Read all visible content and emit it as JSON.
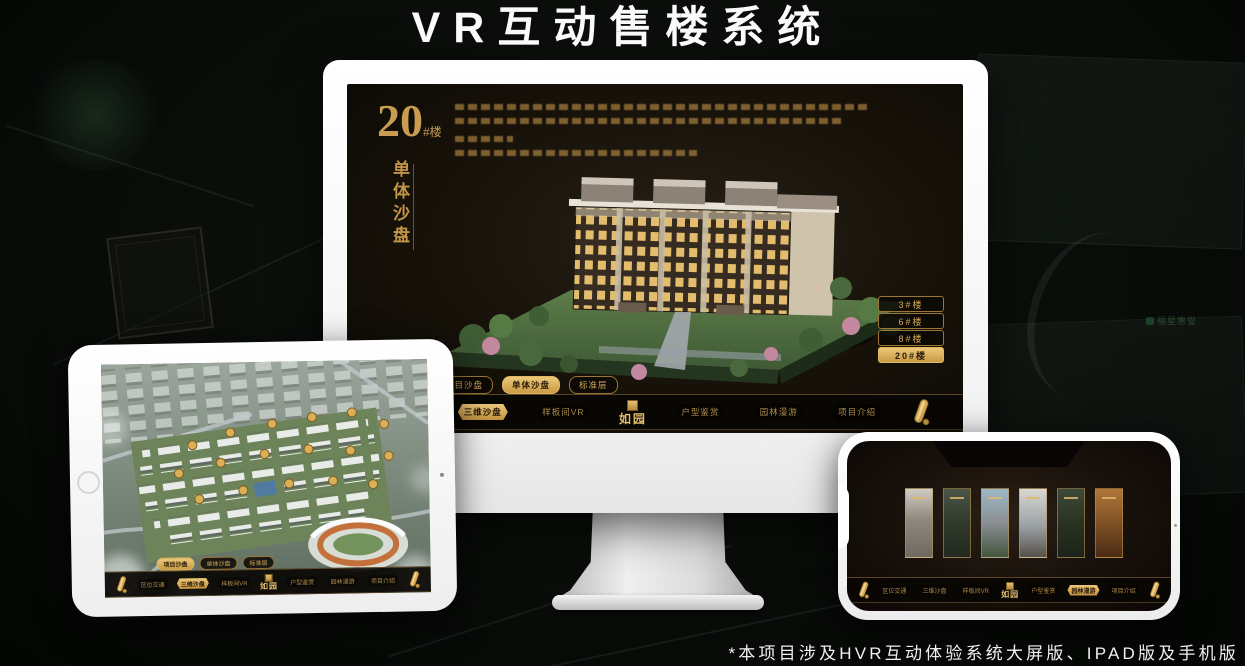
{
  "page": {
    "title": "VR互动售楼系统",
    "footnote": "*本项目涉及HVR互动体验系统大屏版、IPAD版及手机版"
  },
  "background": {
    "watermark": "福星惠誉"
  },
  "colors": {
    "gold": "#c89d52",
    "gold_bright": "#ecc878",
    "screen_dark": "#17120a",
    "device_white": "#ffffff",
    "badge_green": "#2f9457"
  },
  "nav": {
    "items": [
      "区位交通",
      "三维沙盘",
      "样板间VR",
      "户型鉴赏",
      "园林漫游",
      "项目介绍"
    ],
    "logo": "如园",
    "active_desktop": "三维沙盘",
    "active_tablet": "三维沙盘",
    "active_phone": "园林漫游",
    "scroll_icon": "gold-scroll"
  },
  "sub_tabs": {
    "items": [
      "项目沙盘",
      "单体沙盘",
      "标准层"
    ],
    "active_desktop": "单体沙盘",
    "active_tablet": "项目沙盘"
  },
  "desktop": {
    "heading_number": "20",
    "heading_unit": "#楼",
    "heading_vertical": "单体沙盘",
    "description_legible": false,
    "floor_buttons": [
      "3#楼",
      "6#楼",
      "8#楼",
      "20#楼"
    ],
    "floor_active": "20#楼"
  }
}
